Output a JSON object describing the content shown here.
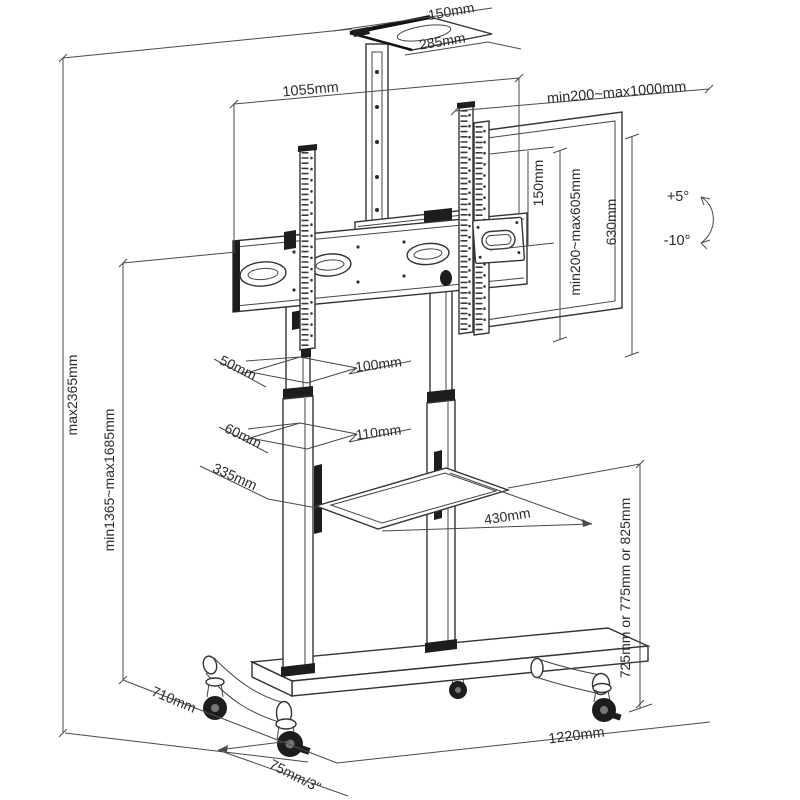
{
  "diagram": {
    "kind": "technical line drawing",
    "subject": "height-adjustable mobile TV stand with VESA mount, shelves and casters"
  },
  "dimensions": {
    "top_shelf_depth": "150mm",
    "top_shelf_width": "285mm",
    "crossbar_width": "1055mm",
    "vesa_width_range": "min200~max1000mm",
    "vesa_plate_height": "150mm",
    "vesa_height_range": "min200~max605mm",
    "bracket_height": "630mm",
    "tilt_up": "+5°",
    "tilt_down": "-10°",
    "overall_height_max": "max2365mm",
    "column_height_range": "min1365~max1685mm",
    "upper_column_depth": "50mm",
    "upper_column_width": "100mm",
    "lower_column_depth": "60mm",
    "lower_column_width": "110mm",
    "tray_depth": "335mm",
    "tray_width": "430mm",
    "tray_height_options": "725mm or 775mm or 825mm",
    "base_depth": "710mm",
    "base_width": "1220mm",
    "caster_size": "75mm/3\""
  }
}
